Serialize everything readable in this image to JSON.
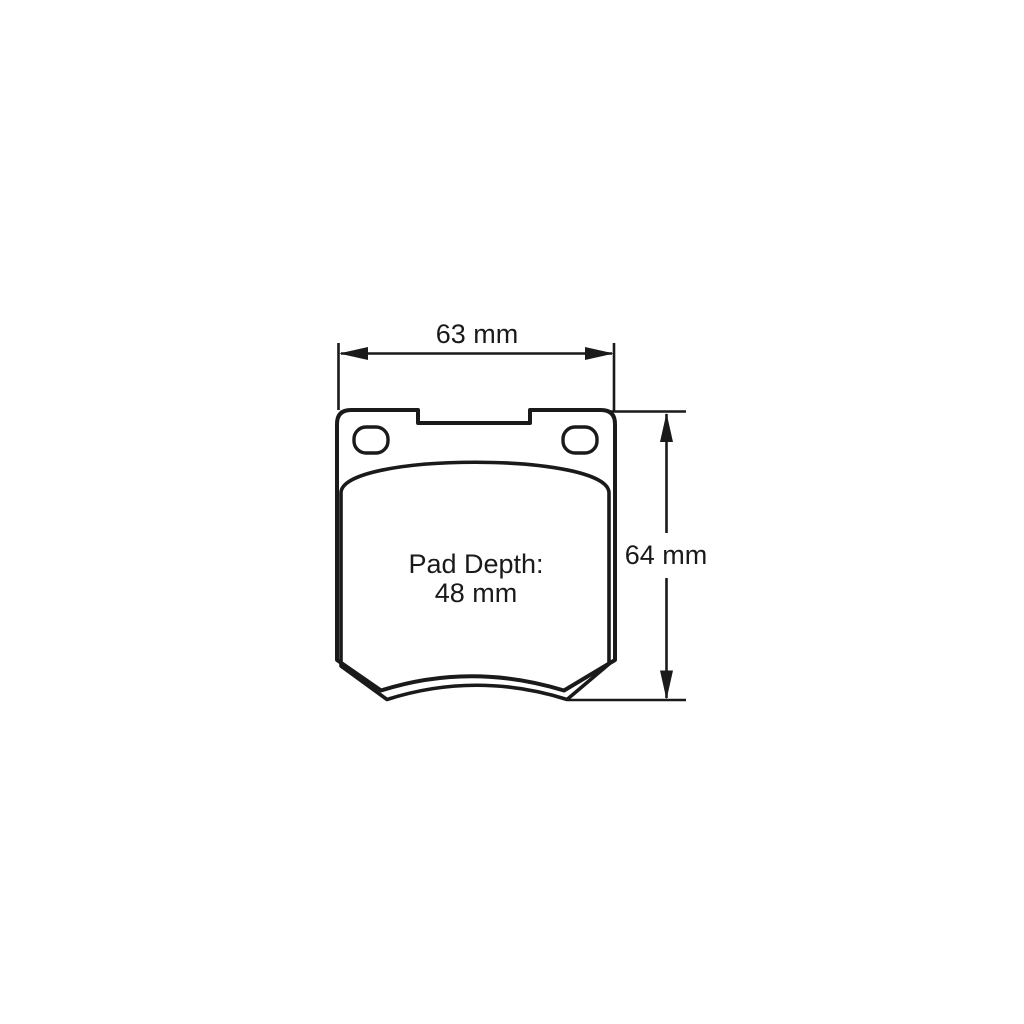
{
  "diagram": {
    "type": "brake-pad-technical-drawing",
    "dimensions": {
      "width_label": "63 mm",
      "height_label": "64 mm"
    },
    "pad_depth": {
      "caption": "Pad Depth:",
      "value": "48 mm"
    },
    "colors": {
      "line": "#1a1a1a",
      "background": "#ffffff"
    }
  }
}
